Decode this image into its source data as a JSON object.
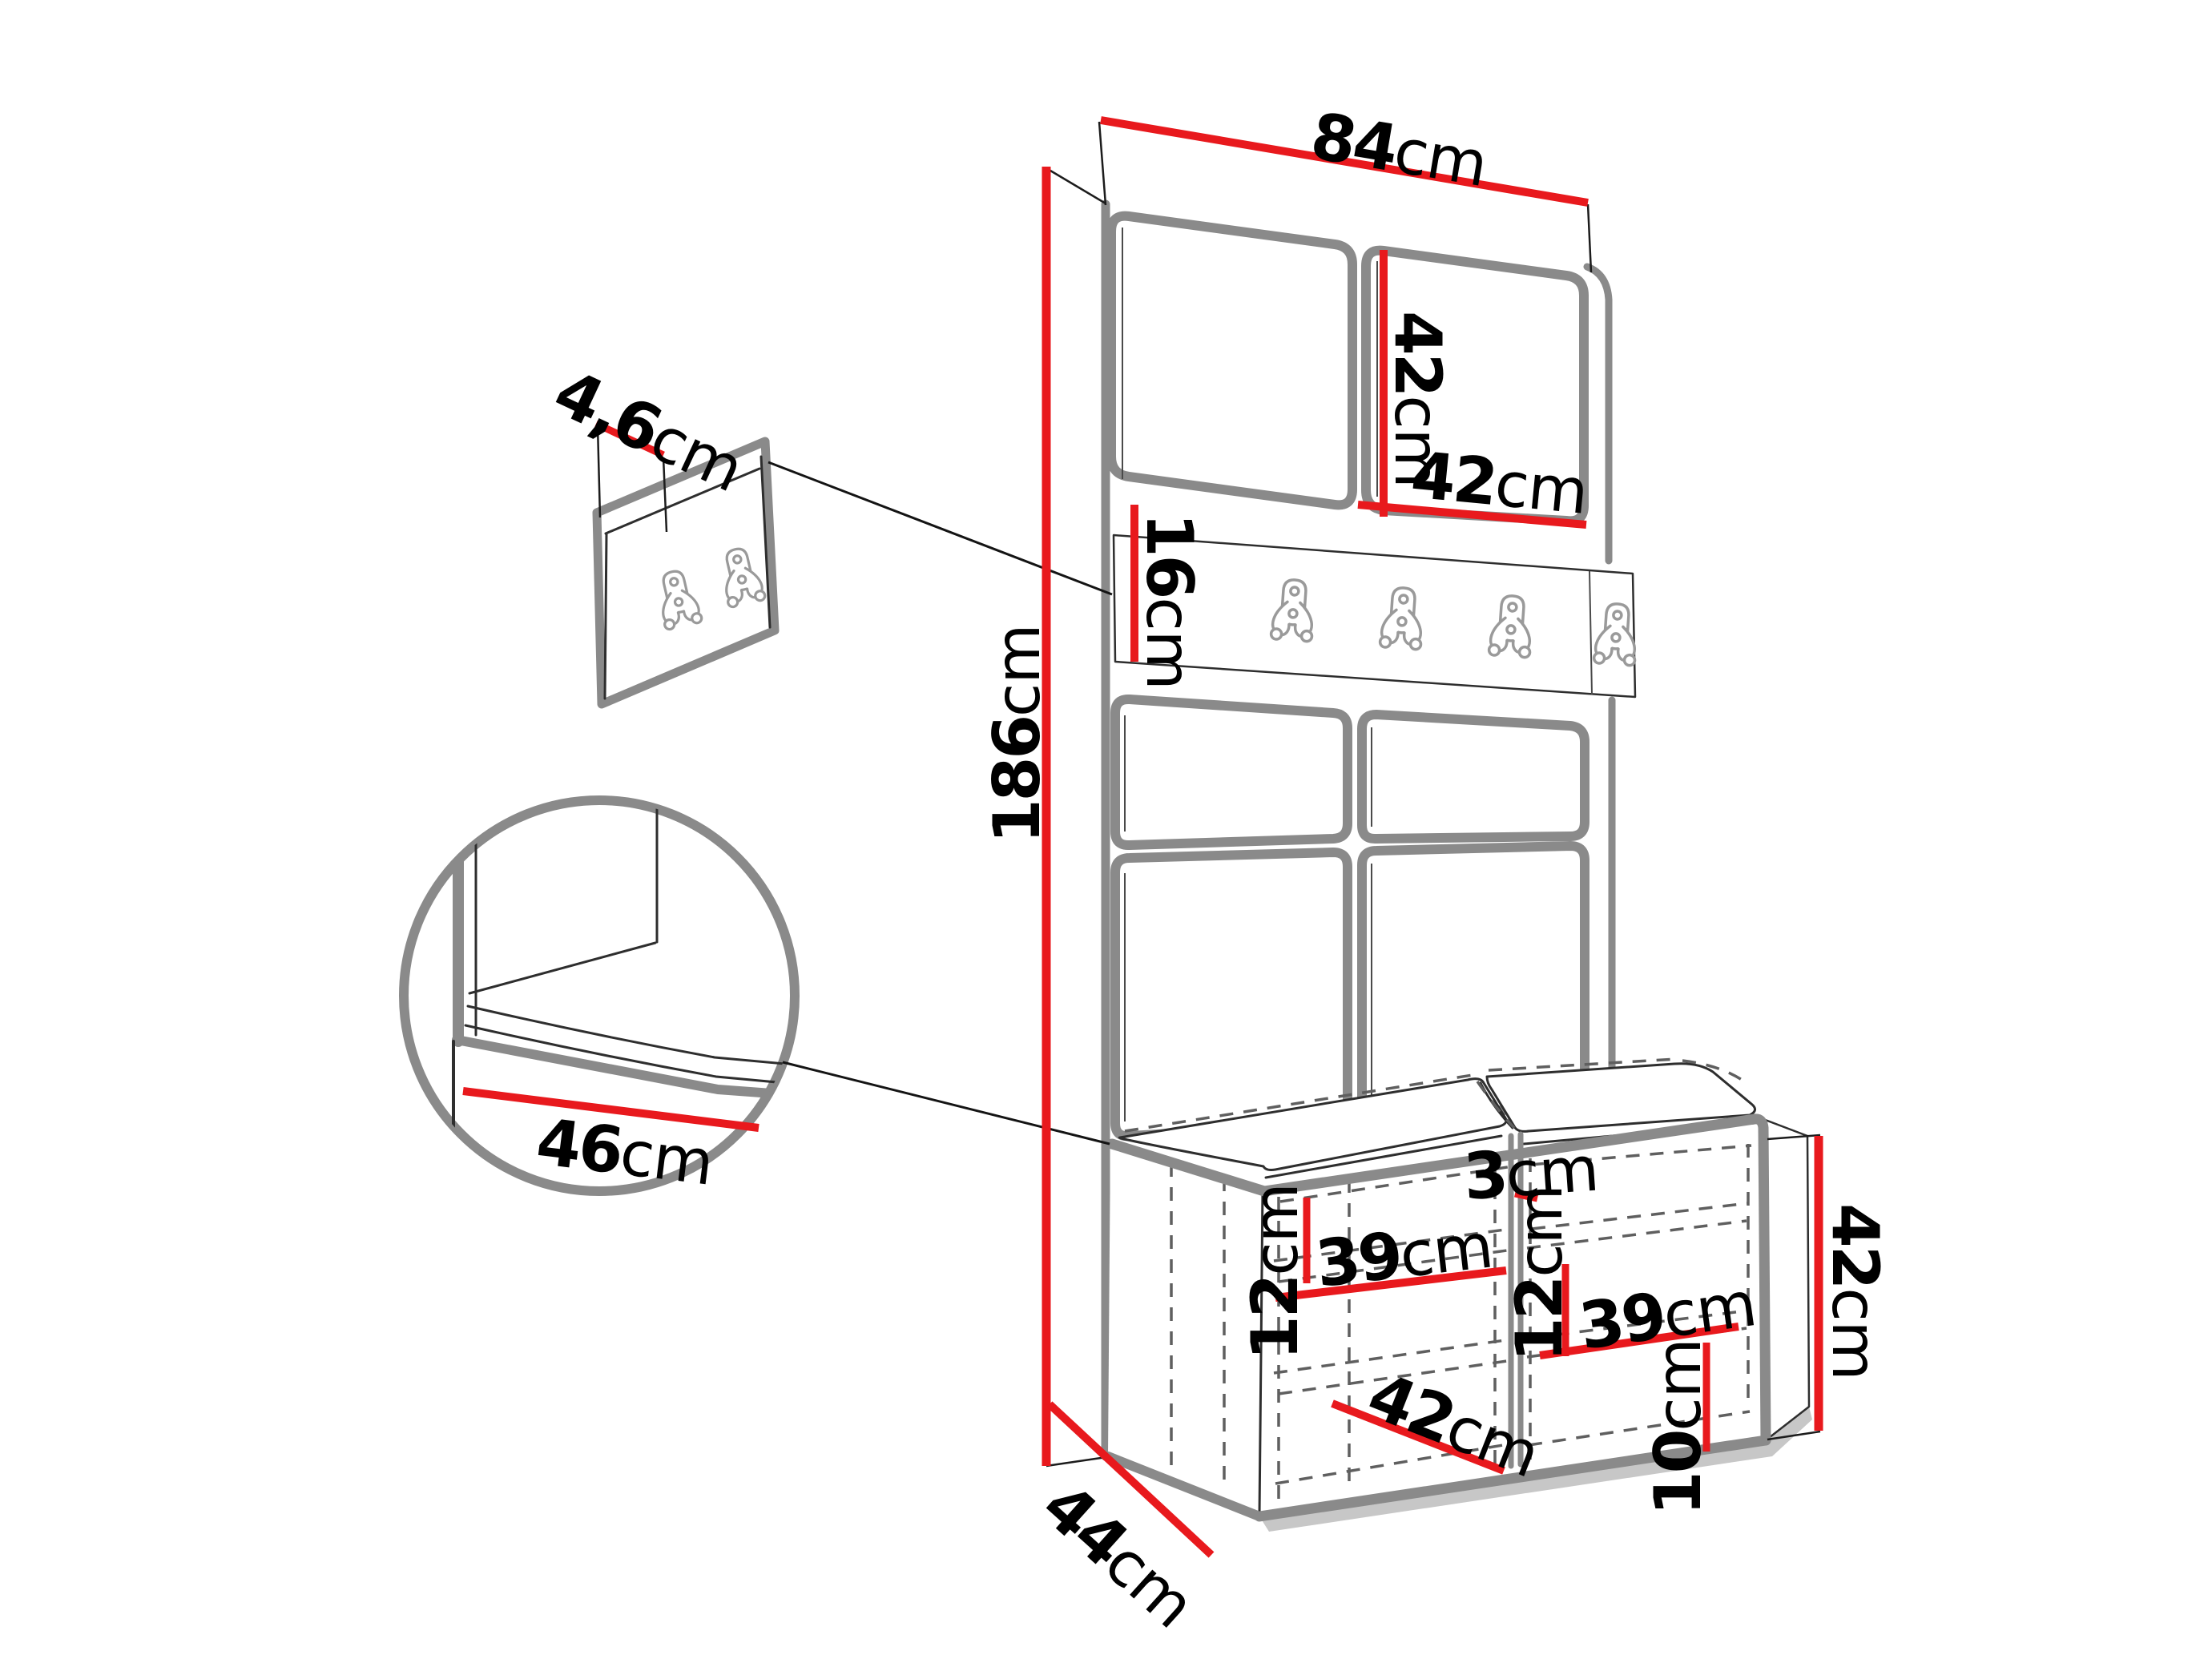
{
  "diagram": {
    "type": "furniture-dimension-diagram",
    "subject": "hallway wardrobe unit with hook rail and shoe bench",
    "colors": {
      "dimension_red": "#e8191d",
      "outline_gray": "#8a8a8a",
      "sketch_dark": "#2e2e2e",
      "dashed_gray": "#5f5f5f",
      "hook_gray": "#9a9a9a",
      "text_black": "#000000",
      "background": "#ffffff"
    },
    "counts": {
      "rail_hooks": 4,
      "detail_panel_hooks": 2,
      "upper_doors": 2,
      "upholstered_panels": 4,
      "bench_compartments": 2,
      "seat_cushions": 2
    },
    "dimensions": {
      "total_width": {
        "value": "84",
        "unit": "cm"
      },
      "top_door_height": {
        "value": "42",
        "unit": "cm"
      },
      "top_door_width": {
        "value": "42",
        "unit": "cm"
      },
      "hook_rail_height": {
        "value": "16",
        "unit": "cm"
      },
      "total_height": {
        "value": "186",
        "unit": "cm"
      },
      "wall_panel_thickness": {
        "value": "4,6",
        "unit": "cm"
      },
      "seat_depth_detail": {
        "value": "46",
        "unit": "cm"
      },
      "bench_depth": {
        "value": "44",
        "unit": "cm"
      },
      "cushion_thickness": {
        "value": "3",
        "unit": "cm"
      },
      "left_shelf_spacing": {
        "value": "12",
        "unit": "cm"
      },
      "left_compartment_width": {
        "value": "39",
        "unit": "cm"
      },
      "right_shelf_spacing": {
        "value": "12",
        "unit": "cm"
      },
      "right_compartment_width": {
        "value": "39",
        "unit": "cm"
      },
      "compartment_depth": {
        "value": "42",
        "unit": "cm"
      },
      "plinth_height": {
        "value": "10",
        "unit": "cm"
      },
      "bench_height": {
        "value": "42",
        "unit": "cm"
      }
    }
  }
}
